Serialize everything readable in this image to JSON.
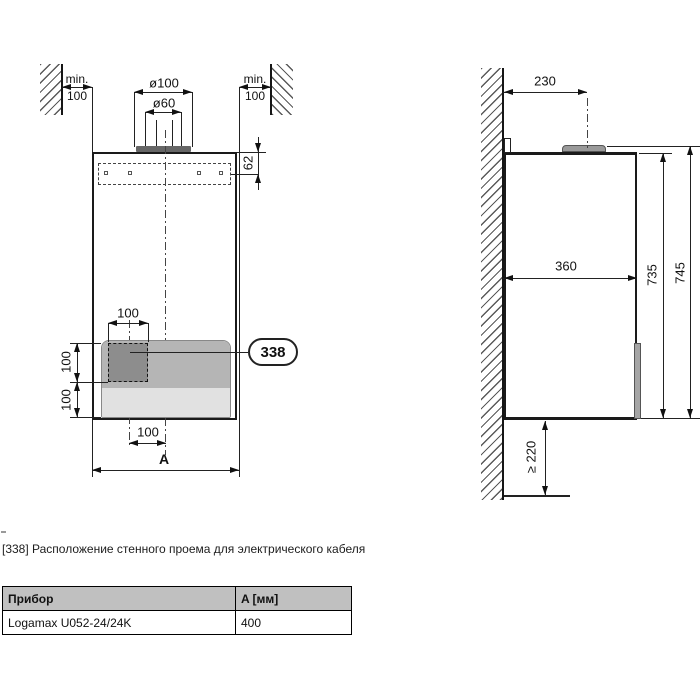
{
  "front_view": {
    "min_clearance_left": {
      "word": "min.",
      "value": "100"
    },
    "min_clearance_right": {
      "word": "min.",
      "value": "100"
    },
    "flue_outer_diameter": "ø100",
    "flue_inner_diameter": "ø60",
    "strip_depth": "62",
    "opening_width_top": "100",
    "opening_height_upper": "100",
    "opening_height_lower": "100",
    "opening_center_offset": "100",
    "overall_width": "A",
    "callout": "338"
  },
  "side_view": {
    "flue_axis_to_wall": "230",
    "depth": "360",
    "casing_height": "735",
    "total_height": "745",
    "min_bottom_clearance": "≥ 220"
  },
  "caption": "[338] Расположение стенного проема для электрического кабеля",
  "table": {
    "headers": [
      "Прибор",
      "A [мм]"
    ],
    "rows": [
      [
        "Logamax U052-24/24K",
        "400"
      ]
    ]
  }
}
